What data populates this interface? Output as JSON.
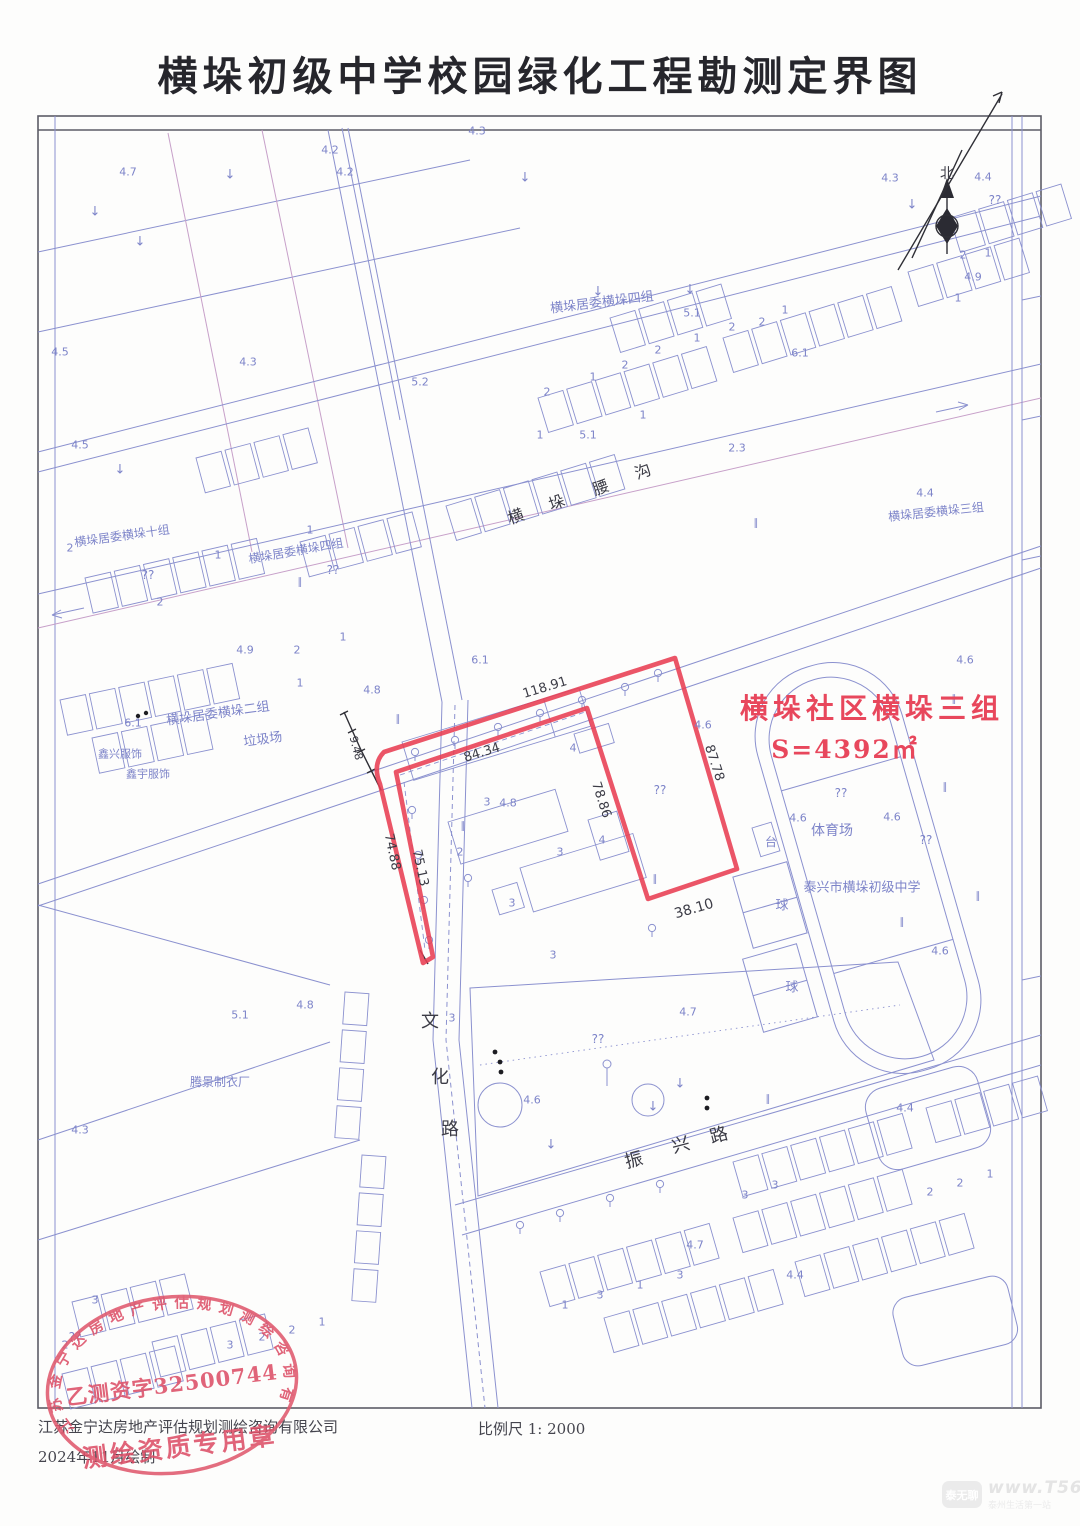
{
  "title": "横垛初级中学校园绿化工程勘测定界图",
  "plot": {
    "name": "横垛社区横垛三组",
    "area": "S=4392㎡",
    "edge_lengths": [
      "118.91",
      "84.34",
      "87.78",
      "78.86",
      "75.13",
      "74.88",
      "38.10",
      "9.48"
    ]
  },
  "footer": {
    "company": "江苏金宁达房地产评估规划测绘咨询有限公司",
    "date": "2024年11月绘制",
    "scale": "比例尺 1: 2000"
  },
  "stamp": {
    "arc_text": "江苏金宁达房地产评估规划测绘咨询有限公司",
    "center_text": "乙测资字32500744",
    "bottom_text": "测绘资质专用章"
  },
  "watermark": {
    "logo": "泰无聊",
    "site": "www.T56.net",
    "tagline": "泰州生活第一站"
  },
  "map": {
    "labels": [
      {
        "t": "北",
        "x": 947,
        "y": 174,
        "s": 14,
        "c": "k"
      },
      {
        "t": "横垛居委横垛十组",
        "x": 122,
        "y": 536,
        "r": -8,
        "s": 12
      },
      {
        "t": "横垛居委横垛四组",
        "x": 296,
        "y": 551,
        "r": -10,
        "s": 12
      },
      {
        "t": "横垛居委横垛四组",
        "x": 602,
        "y": 303,
        "r": -7,
        "s": 13
      },
      {
        "t": "横垛居委横垛三组",
        "x": 936,
        "y": 512,
        "r": -6,
        "s": 12
      },
      {
        "t": "横垛居委横垛二组",
        "x": 218,
        "y": 714,
        "r": -8,
        "s": 13
      },
      {
        "t": "垃圾场",
        "x": 263,
        "y": 740,
        "r": -8,
        "s": 13
      },
      {
        "t": "鑫兴服饰",
        "x": 120,
        "y": 754,
        "s": 11
      },
      {
        "t": "鑫宇服饰",
        "x": 148,
        "y": 774,
        "s": 11
      },
      {
        "t": "腾景制衣厂",
        "x": 220,
        "y": 1082,
        "s": 12
      },
      {
        "t": "体育场",
        "x": 832,
        "y": 831,
        "s": 14
      },
      {
        "t": "泰兴市横垛初级中学",
        "x": 862,
        "y": 888,
        "s": 13
      },
      {
        "t": "球",
        "x": 782,
        "y": 906,
        "s": 13
      },
      {
        "t": "球",
        "x": 792,
        "y": 988,
        "s": 13
      },
      {
        "t": "台",
        "x": 771,
        "y": 842,
        "s": 12
      },
      {
        "t": "文",
        "x": 430,
        "y": 1022,
        "s": 18,
        "c": "k"
      },
      {
        "t": "化",
        "x": 440,
        "y": 1078,
        "s": 18,
        "c": "k"
      },
      {
        "t": "路",
        "x": 450,
        "y": 1130,
        "s": 18,
        "c": "k"
      },
      {
        "t": "振",
        "x": 634,
        "y": 1161,
        "r": -15,
        "s": 18,
        "c": "k"
      },
      {
        "t": "兴",
        "x": 681,
        "y": 1146,
        "r": -15,
        "s": 18,
        "c": "k"
      },
      {
        "t": "路",
        "x": 719,
        "y": 1136,
        "r": -15,
        "s": 18,
        "c": "k"
      },
      {
        "t": "横",
        "x": 516,
        "y": 517,
        "r": -20,
        "s": 16,
        "c": "k"
      },
      {
        "t": "垛",
        "x": 557,
        "y": 503,
        "r": -20,
        "s": 16,
        "c": "k"
      },
      {
        "t": "腰",
        "x": 601,
        "y": 488,
        "r": -20,
        "s": 16,
        "c": "k"
      },
      {
        "t": "沟",
        "x": 643,
        "y": 472,
        "r": -20,
        "s": 16,
        "c": "k"
      },
      {
        "t": "118.91",
        "x": 545,
        "y": 688,
        "r": -17,
        "s": 13,
        "c": "k"
      },
      {
        "t": "84.34",
        "x": 482,
        "y": 753,
        "r": -17,
        "s": 13,
        "c": "k"
      },
      {
        "t": "87.78",
        "x": 714,
        "y": 763,
        "r": 72,
        "s": 13,
        "c": "k"
      },
      {
        "t": "78.86",
        "x": 601,
        "y": 800,
        "r": 72,
        "s": 13,
        "c": "k"
      },
      {
        "t": "38.10",
        "x": 694,
        "y": 909,
        "r": -16,
        "s": 14,
        "c": "k"
      },
      {
        "t": "75.13",
        "x": 420,
        "y": 868,
        "r": 78,
        "s": 13,
        "c": "k"
      },
      {
        "t": "74.88",
        "x": 392,
        "y": 852,
        "r": 78,
        "s": 13,
        "c": "k"
      },
      {
        "t": "9.48",
        "x": 356,
        "y": 748,
        "r": 75,
        "s": 11,
        "c": "k"
      },
      {
        "t": "4.2",
        "x": 330,
        "y": 150
      },
      {
        "t": "4.3",
        "x": 477,
        "y": 131
      },
      {
        "t": "4.7",
        "x": 128,
        "y": 172
      },
      {
        "t": "4.2",
        "x": 345,
        "y": 172
      },
      {
        "t": "4.3",
        "x": 890,
        "y": 178
      },
      {
        "t": "4.4",
        "x": 983,
        "y": 177
      },
      {
        "t": "4.9",
        "x": 973,
        "y": 277
      },
      {
        "t": "4.5",
        "x": 60,
        "y": 352
      },
      {
        "t": "4.3",
        "x": 248,
        "y": 362
      },
      {
        "t": "5.2",
        "x": 420,
        "y": 382
      },
      {
        "t": "4.5",
        "x": 80,
        "y": 445
      },
      {
        "t": "5.1",
        "x": 588,
        "y": 435
      },
      {
        "t": "5.1",
        "x": 692,
        "y": 313
      },
      {
        "t": "2.3",
        "x": 737,
        "y": 448
      },
      {
        "t": "6.1",
        "x": 800,
        "y": 353
      },
      {
        "t": "4.9",
        "x": 245,
        "y": 650
      },
      {
        "t": "6.1",
        "x": 133,
        "y": 723
      },
      {
        "t": "6.1",
        "x": 480,
        "y": 660
      },
      {
        "t": "4.8",
        "x": 372,
        "y": 690
      },
      {
        "t": "4.6",
        "x": 703,
        "y": 725
      },
      {
        "t": "4.6",
        "x": 798,
        "y": 818
      },
      {
        "t": "4.6",
        "x": 892,
        "y": 817
      },
      {
        "t": "4.6",
        "x": 940,
        "y": 951
      },
      {
        "t": "4.6",
        "x": 965,
        "y": 660
      },
      {
        "t": "4.4",
        "x": 925,
        "y": 493
      },
      {
        "t": "4.8",
        "x": 305,
        "y": 1005
      },
      {
        "t": "4.7",
        "x": 688,
        "y": 1012
      },
      {
        "t": "4.3",
        "x": 80,
        "y": 1130
      },
      {
        "t": "4.6",
        "x": 532,
        "y": 1100
      },
      {
        "t": "4.4",
        "x": 905,
        "y": 1108
      },
      {
        "t": "4.4",
        "x": 795,
        "y": 1275
      },
      {
        "t": "5.1",
        "x": 240,
        "y": 1015
      },
      {
        "t": "4.7",
        "x": 695,
        "y": 1245
      },
      {
        "t": "4.8",
        "x": 508,
        "y": 803
      },
      {
        "t": "??",
        "x": 148,
        "y": 575,
        "s": 12
      },
      {
        "t": "??",
        "x": 333,
        "y": 570,
        "s": 12
      },
      {
        "t": "??",
        "x": 995,
        "y": 200,
        "s": 12
      },
      {
        "t": "??",
        "x": 841,
        "y": 793,
        "s": 12
      },
      {
        "t": "??",
        "x": 926,
        "y": 840,
        "s": 12
      },
      {
        "t": "??",
        "x": 660,
        "y": 790,
        "s": 12
      },
      {
        "t": "??",
        "x": 598,
        "y": 1039,
        "s": 12
      },
      {
        "t": "??",
        "x": 75,
        "y": 1337,
        "s": 12
      },
      {
        "t": "↓",
        "x": 230,
        "y": 175,
        "s": 13
      },
      {
        "t": "↓",
        "x": 525,
        "y": 178,
        "s": 13
      },
      {
        "t": "↓",
        "x": 598,
        "y": 292,
        "s": 13
      },
      {
        "t": "↓",
        "x": 690,
        "y": 290,
        "s": 13
      },
      {
        "t": "↓",
        "x": 912,
        "y": 205,
        "s": 13
      },
      {
        "t": "↓",
        "x": 95,
        "y": 212,
        "s": 13
      },
      {
        "t": "↓",
        "x": 140,
        "y": 242,
        "s": 13
      },
      {
        "t": "↓",
        "x": 120,
        "y": 470,
        "s": 13
      },
      {
        "t": "↓",
        "x": 653,
        "y": 1107,
        "s": 13
      },
      {
        "t": "↓",
        "x": 551,
        "y": 1145,
        "s": 13
      },
      {
        "t": "↓",
        "x": 680,
        "y": 1084,
        "s": 13
      },
      {
        "t": "∥",
        "x": 945,
        "y": 788,
        "s": 10
      },
      {
        "t": "∥",
        "x": 978,
        "y": 897,
        "s": 10
      },
      {
        "t": "∥",
        "x": 902,
        "y": 923,
        "s": 10
      },
      {
        "t": "∥",
        "x": 655,
        "y": 880,
        "s": 10
      },
      {
        "t": "∥",
        "x": 463,
        "y": 827,
        "s": 10
      },
      {
        "t": "∥",
        "x": 954,
        "y": 700,
        "s": 10
      },
      {
        "t": "∥",
        "x": 756,
        "y": 524,
        "s": 10
      },
      {
        "t": "∥",
        "x": 398,
        "y": 720,
        "s": 10
      },
      {
        "t": "∥",
        "x": 300,
        "y": 583,
        "s": 10
      },
      {
        "t": "∥",
        "x": 768,
        "y": 1100,
        "s": 10
      },
      {
        "t": "2",
        "x": 547,
        "y": 392
      },
      {
        "t": "1",
        "x": 593,
        "y": 377
      },
      {
        "t": "2",
        "x": 625,
        "y": 365
      },
      {
        "t": "2",
        "x": 658,
        "y": 350
      },
      {
        "t": "1",
        "x": 697,
        "y": 338
      },
      {
        "t": "2",
        "x": 732,
        "y": 327
      },
      {
        "t": "2",
        "x": 762,
        "y": 322
      },
      {
        "t": "1",
        "x": 785,
        "y": 310
      },
      {
        "t": "1",
        "x": 643,
        "y": 415
      },
      {
        "t": "1",
        "x": 540,
        "y": 435
      },
      {
        "t": "2",
        "x": 70,
        "y": 548
      },
      {
        "t": "2",
        "x": 160,
        "y": 602
      },
      {
        "t": "1",
        "x": 218,
        "y": 555
      },
      {
        "t": "1",
        "x": 310,
        "y": 530
      },
      {
        "t": "2",
        "x": 297,
        "y": 650
      },
      {
        "t": "1",
        "x": 343,
        "y": 637
      },
      {
        "t": "1",
        "x": 300,
        "y": 683
      },
      {
        "t": "2",
        "x": 963,
        "y": 255
      },
      {
        "t": "1",
        "x": 988,
        "y": 253
      },
      {
        "t": "1",
        "x": 958,
        "y": 298
      },
      {
        "t": "3",
        "x": 487,
        "y": 802
      },
      {
        "t": "2",
        "x": 460,
        "y": 852
      },
      {
        "t": "3",
        "x": 560,
        "y": 852
      },
      {
        "t": "4",
        "x": 573,
        "y": 748
      },
      {
        "t": "4",
        "x": 602,
        "y": 840
      },
      {
        "t": "3",
        "x": 512,
        "y": 903
      },
      {
        "t": "3",
        "x": 553,
        "y": 955
      },
      {
        "t": "3",
        "x": 452,
        "y": 1018
      },
      {
        "t": "3",
        "x": 745,
        "y": 1195
      },
      {
        "t": "3",
        "x": 775,
        "y": 1185
      },
      {
        "t": "2",
        "x": 930,
        "y": 1192
      },
      {
        "t": "2",
        "x": 960,
        "y": 1183
      },
      {
        "t": "1",
        "x": 990,
        "y": 1174
      },
      {
        "t": "1",
        "x": 565,
        "y": 1305
      },
      {
        "t": "3",
        "x": 600,
        "y": 1295
      },
      {
        "t": "1",
        "x": 640,
        "y": 1285
      },
      {
        "t": "3",
        "x": 680,
        "y": 1275
      },
      {
        "t": "3",
        "x": 230,
        "y": 1345
      },
      {
        "t": "2",
        "x": 262,
        "y": 1337
      },
      {
        "t": "2",
        "x": 292,
        "y": 1330
      },
      {
        "t": "1",
        "x": 322,
        "y": 1322
      },
      {
        "t": "3",
        "x": 95,
        "y": 1300
      },
      {
        "t": "2",
        "x": 65,
        "y": 1345
      }
    ]
  }
}
